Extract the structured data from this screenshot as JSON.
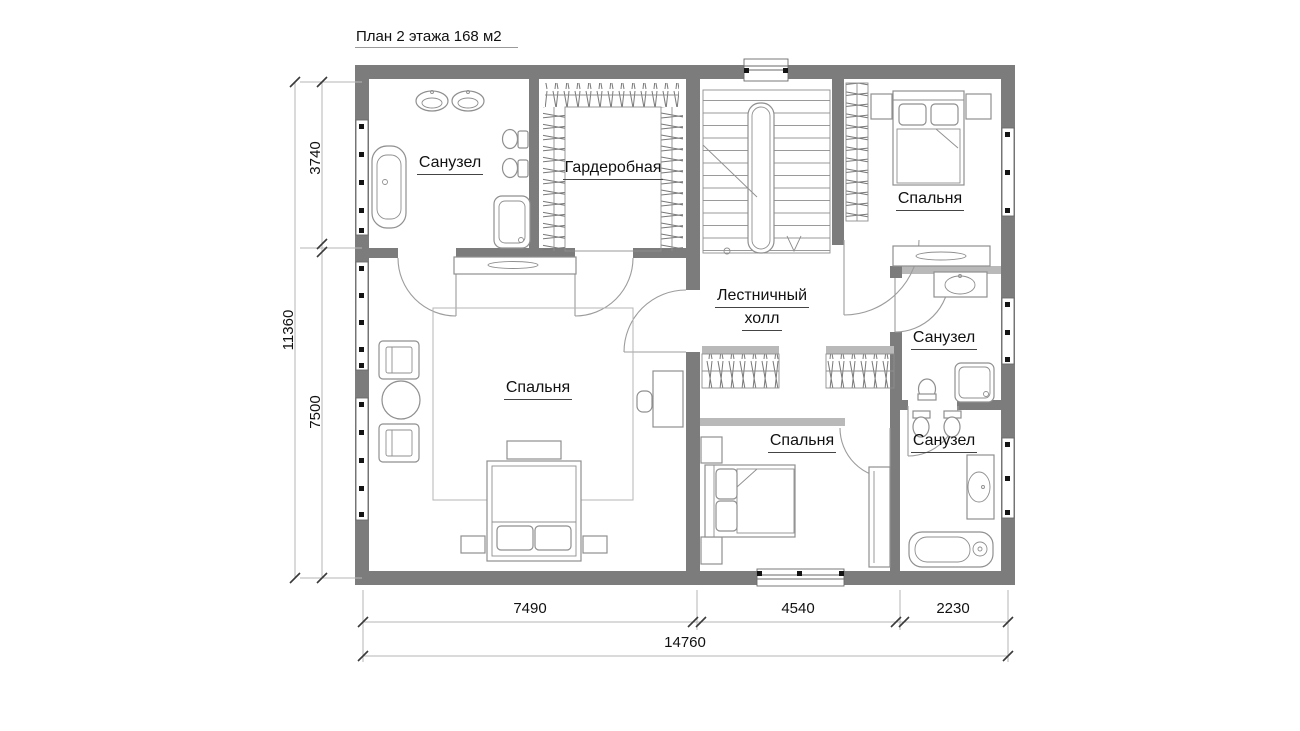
{
  "title": "План 2 этажа 168 м2",
  "colors": {
    "wall": "#7c7c7c",
    "wall_light": "#b9b9b9",
    "furniture_line": "#8f8f8f",
    "dim_line": "#b6b6b6",
    "text": "#111111"
  },
  "rooms": [
    {
      "id": "bathroom-master",
      "label": "Санузел"
    },
    {
      "id": "dressing-room",
      "label": "Гардеробная"
    },
    {
      "id": "stair-hall",
      "label": "Лестничный холл",
      "line1": "Лестничный",
      "line2": "холл"
    },
    {
      "id": "bedroom-top-right",
      "label": "Спальня"
    },
    {
      "id": "bathroom-middle-right",
      "label": "Санузел"
    },
    {
      "id": "bathroom-bottom-right",
      "label": "Санузел"
    },
    {
      "id": "bedroom-master",
      "label": "Спальня"
    },
    {
      "id": "bedroom-bottom",
      "label": "Спальня"
    }
  ],
  "dimensions": {
    "vertical_total": "11360",
    "vertical_top": "3740",
    "vertical_bottom": "7500",
    "horizontal_left": "7490",
    "horizontal_middle": "4540",
    "horizontal_right": "2230",
    "horizontal_total": "14760"
  }
}
